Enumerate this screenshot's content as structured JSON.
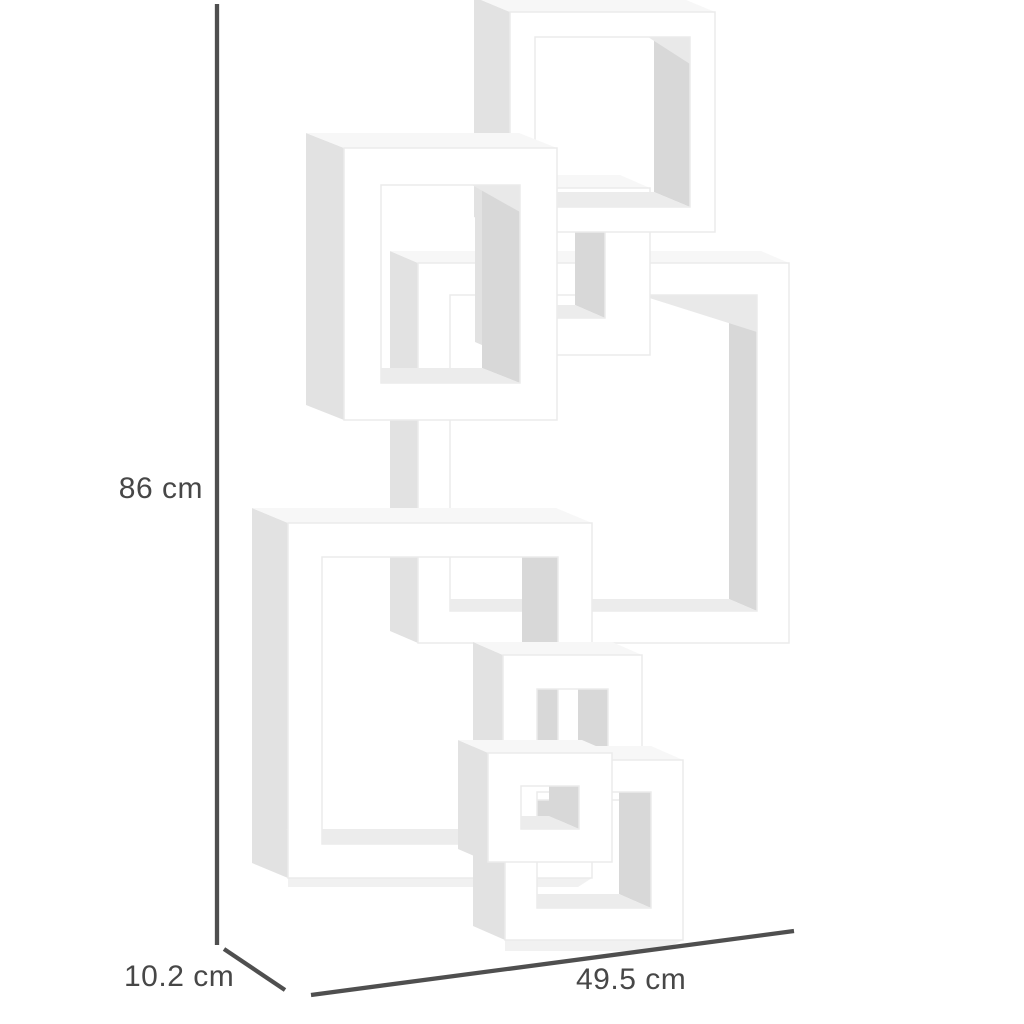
{
  "scene": {
    "description": "Product dimension diagram of a white interlocking cube floating wall shelf, shown in three-quarter perspective on a plain white background",
    "shelf_shape": "six interlocking open square cubes arranged in a zig-zag from top-right to bottom-right"
  },
  "dimensions": {
    "height": {
      "label": "86 cm",
      "value": 86,
      "unit": "cm",
      "orientation": "vertical, left side"
    },
    "depth": {
      "label": "10.2 cm",
      "value": 10.2,
      "unit": "cm",
      "orientation": "diagonal, bottom-left"
    },
    "width": {
      "label": "49.5 cm",
      "value": 49.5,
      "unit": "cm",
      "orientation": "slanted horizontal, bottom"
    }
  },
  "colors": {
    "background": "#ffffff",
    "dimension_line": "#4f4f4f",
    "label_text": "#474747",
    "shelf_front": "#ffffff",
    "shelf_outline": "#ebebeb",
    "shelf_left_shade": "#e2e2e2",
    "shelf_top_shade": "#f7f7f7",
    "shelf_inner_right_shade": "#d8d8d8",
    "shelf_inner_bottom_shade": "#ececec"
  }
}
